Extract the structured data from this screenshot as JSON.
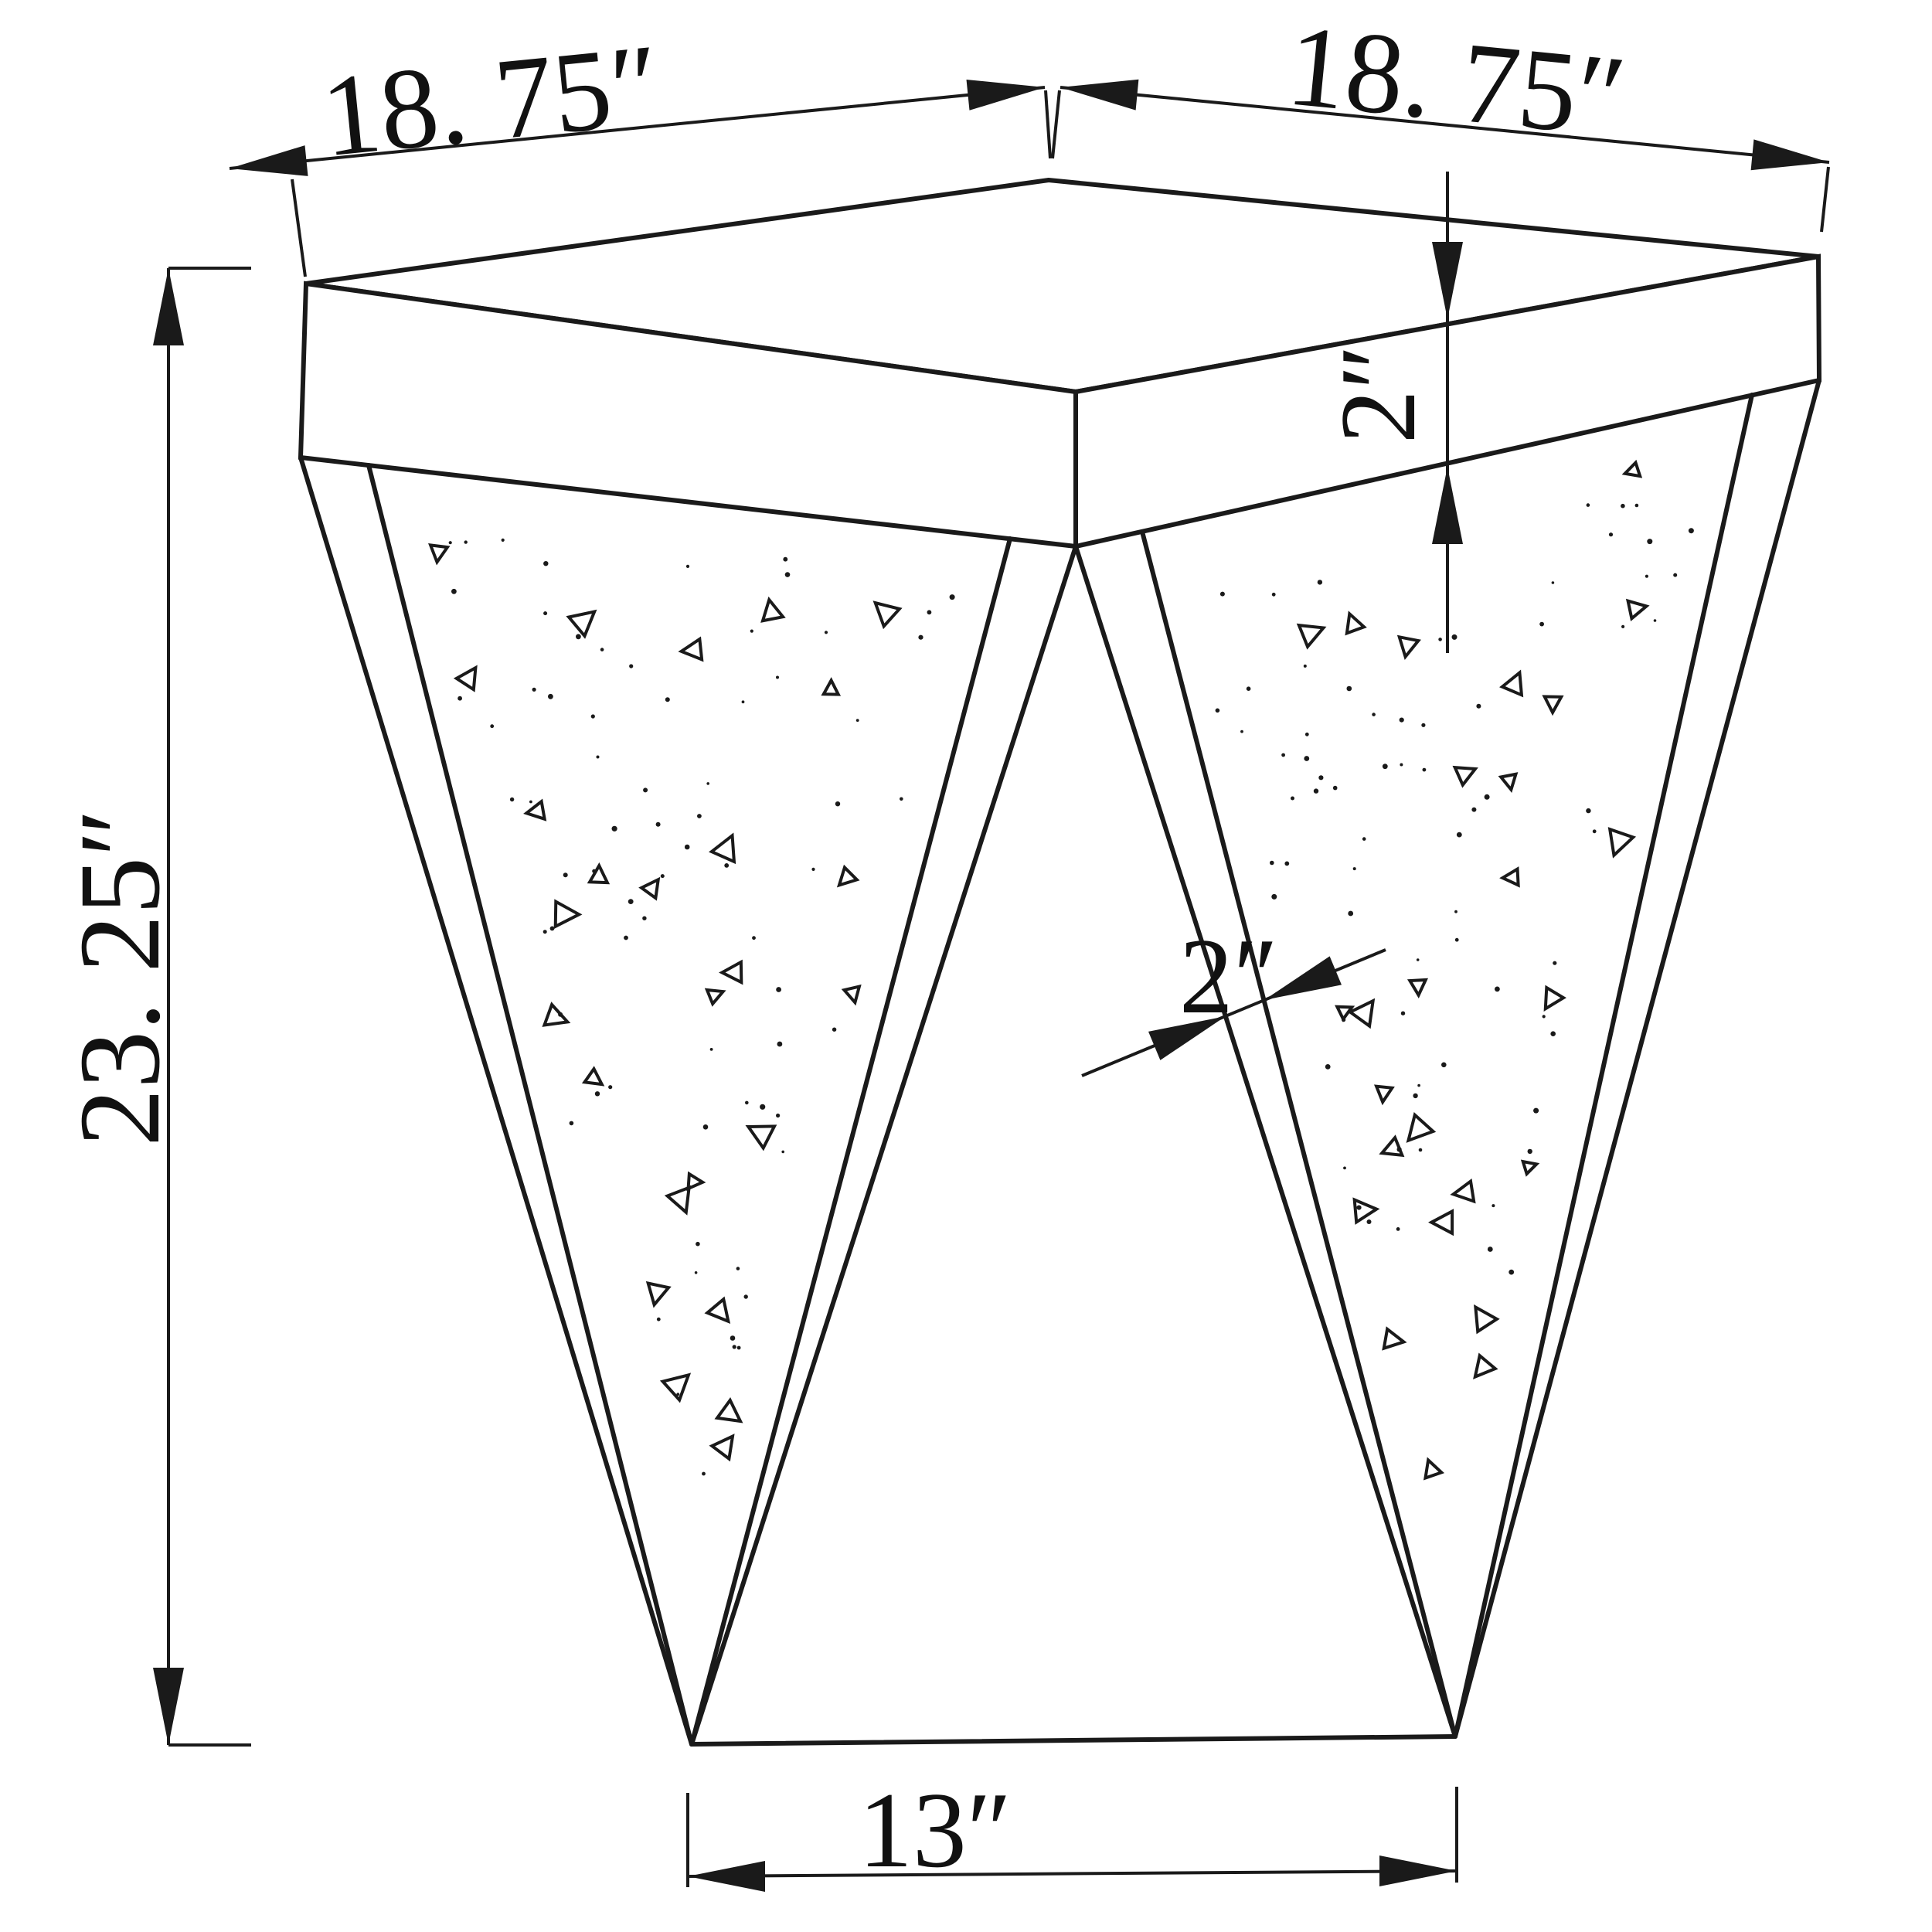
{
  "diagram": {
    "type": "technical line drawing",
    "subject": "square-top accent end table with V-shaped mirrored legs",
    "background_color": "#ffffff",
    "line_color": "#1a1a1a",
    "labels": {
      "top_width_left": "18. 75″",
      "top_width_right": "18. 75″",
      "overall_height": "23. 25″",
      "top_thickness": "2″",
      "leg_frame_width": "2″",
      "base_span": "13″"
    },
    "texture": {
      "dots_per_panel": 72,
      "triangles_per_panel": 26,
      "seed": 42
    }
  }
}
